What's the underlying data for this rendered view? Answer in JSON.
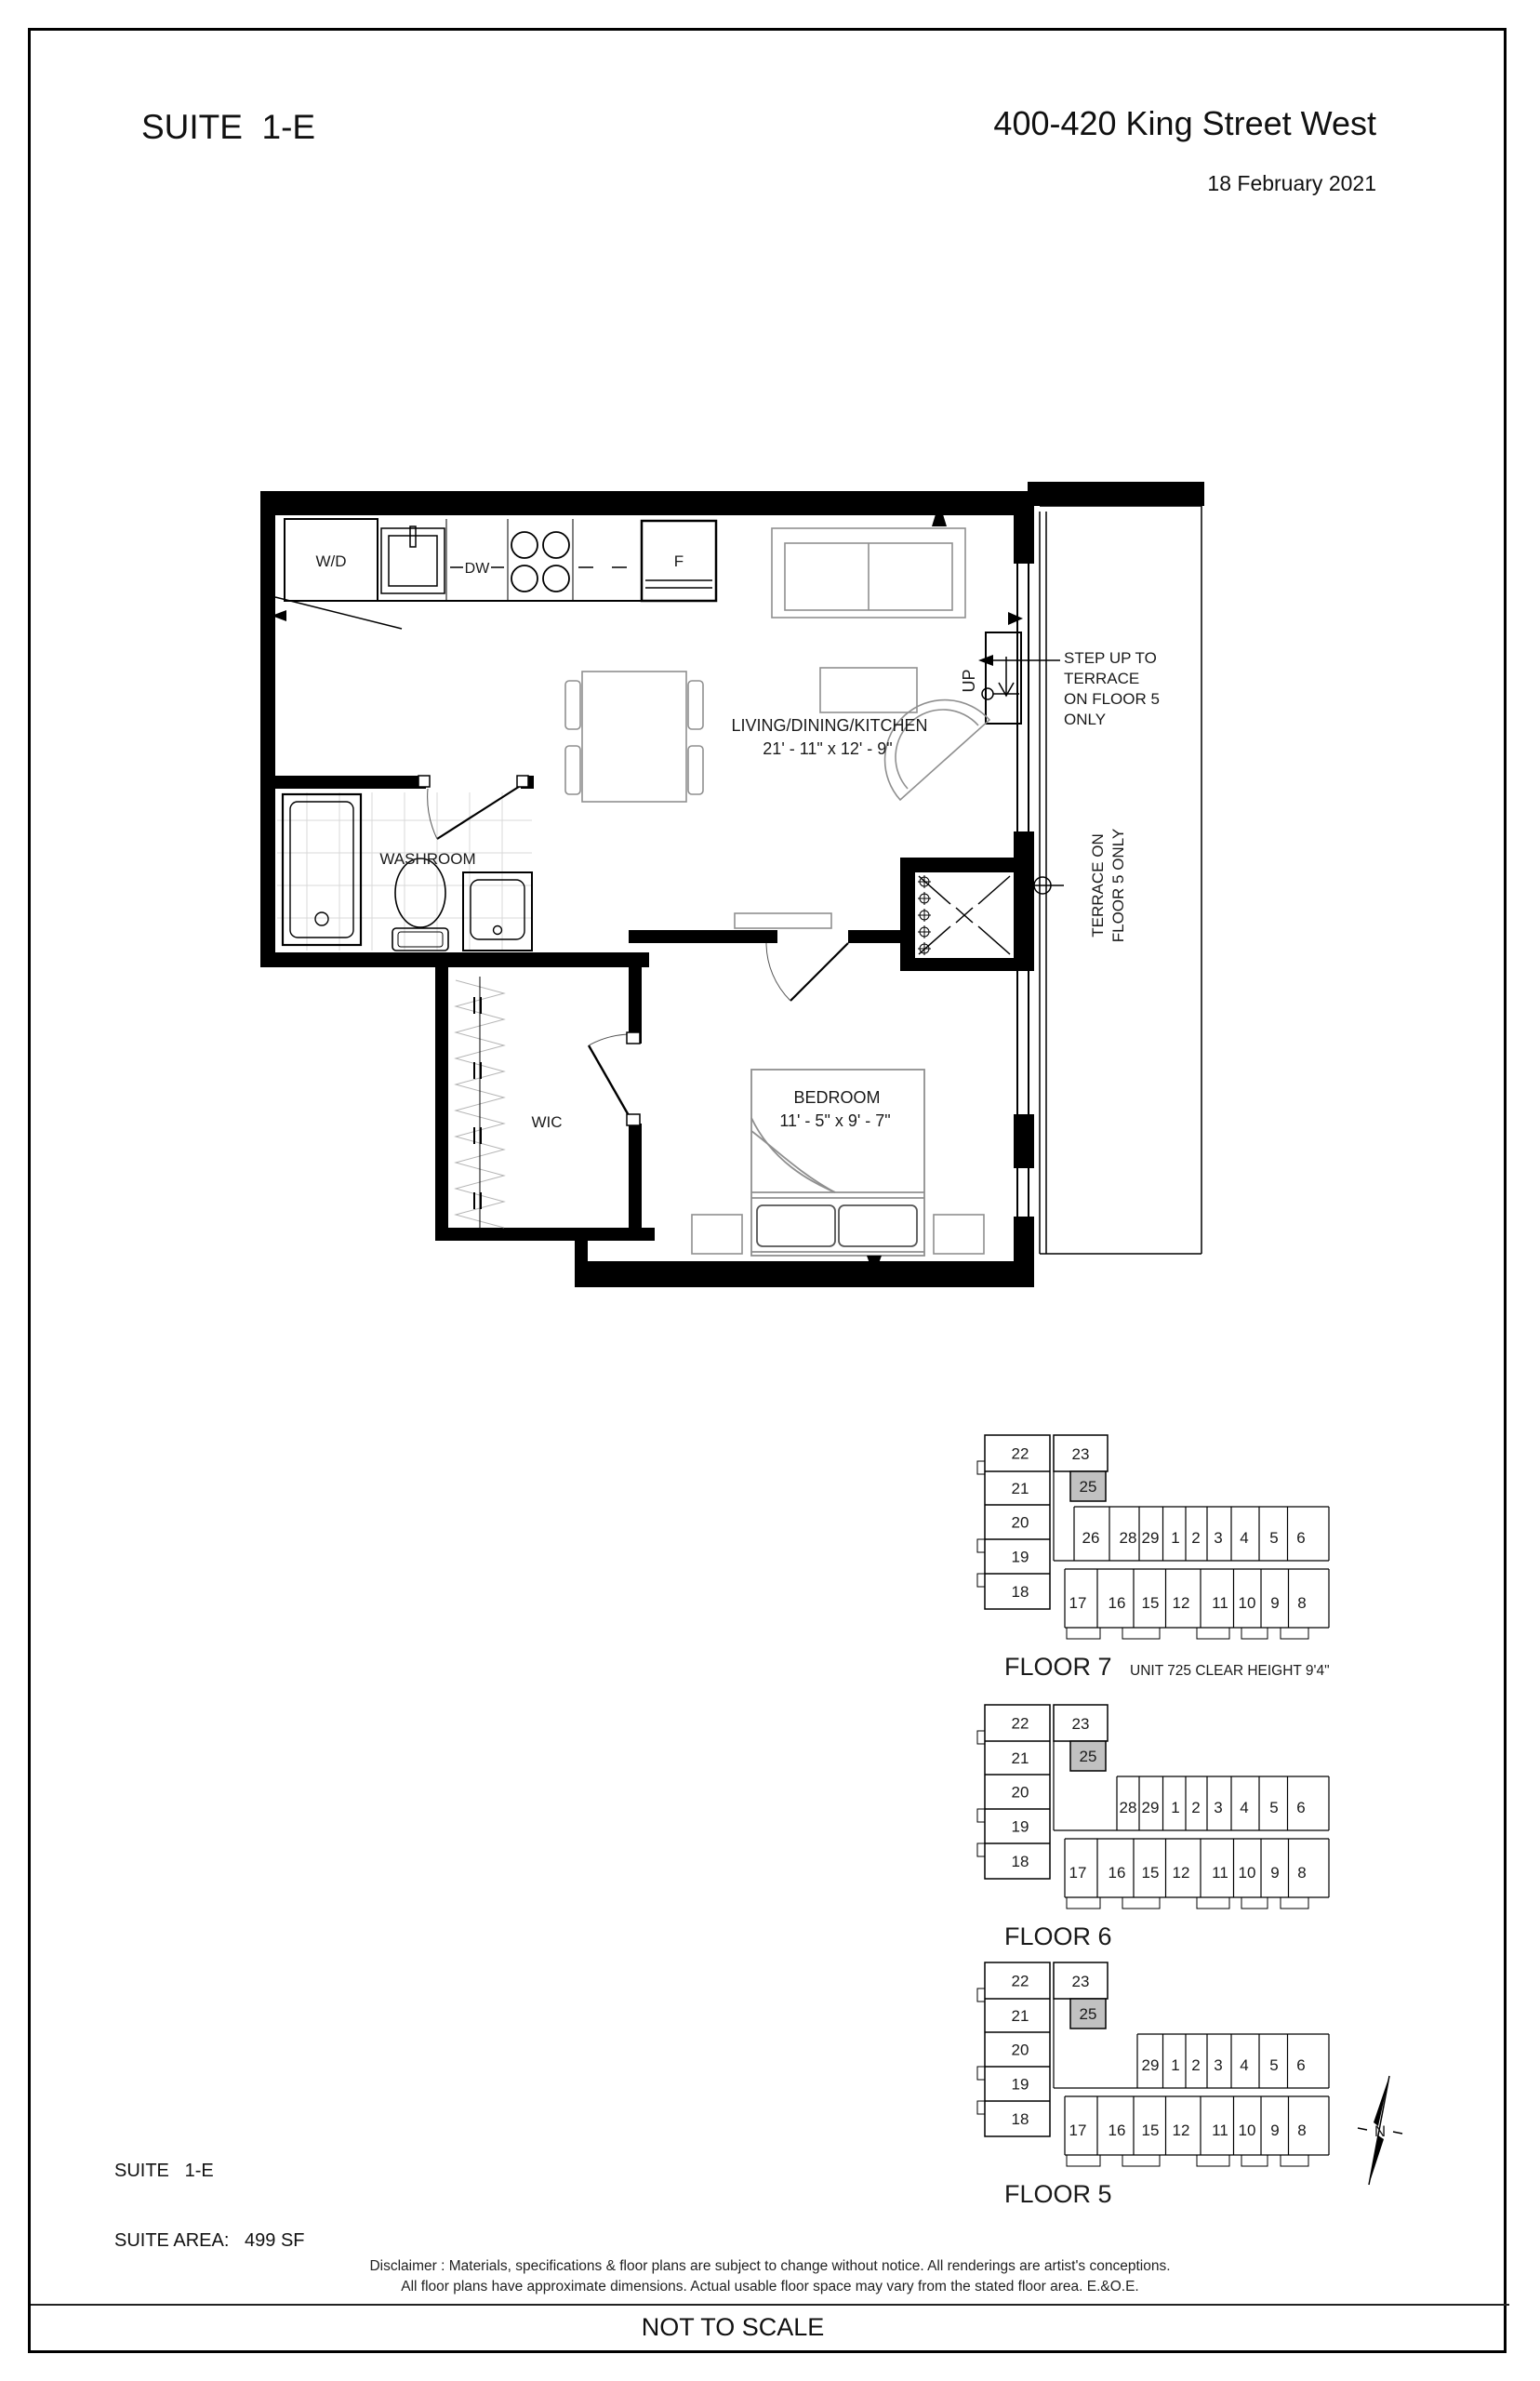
{
  "header": {
    "suite_title": "SUITE  1-E",
    "address": "400-420 King Street West",
    "date": "18 February 2021"
  },
  "floor_plan": {
    "labels": {
      "wd": "W/D",
      "dw": "DW",
      "fridge": "F",
      "living_name": "LIVING/DINING/KITCHEN",
      "living_dims": "21' - 11\" x 12' - 9\"",
      "washroom": "WASHROOM",
      "wic": "WIC",
      "bedroom_name": "BEDROOM",
      "bedroom_dims": "11' - 5\" x 9' - 7\"",
      "up": "UP",
      "step_note": [
        "STEP UP TO",
        "TERRACE",
        "ON FLOOR 5",
        "ONLY"
      ],
      "terrace_note": [
        "TERRACE ON",
        "FLOOR 5 ONLY"
      ]
    }
  },
  "key_plans": [
    {
      "name": "FLOOR 7",
      "annotation": "UNIT 725 CLEAR HEIGHT 9'4\"",
      "left_units": [
        "22",
        "21",
        "20",
        "19",
        "18"
      ],
      "upper_unit": "23",
      "highlight_unit": "25",
      "top_units": [
        "26",
        "28",
        "29",
        "1",
        "2",
        "3",
        "4",
        "5",
        "6"
      ],
      "bottom_units": [
        "17",
        "16",
        "15",
        "12",
        "11",
        "10",
        "9",
        "8"
      ]
    },
    {
      "name": "FLOOR 6",
      "annotation": "",
      "left_units": [
        "22",
        "21",
        "20",
        "19",
        "18"
      ],
      "upper_unit": "23",
      "highlight_unit": "25",
      "top_units": [
        "28",
        "29",
        "1",
        "2",
        "3",
        "4",
        "5",
        "6"
      ],
      "bottom_units": [
        "17",
        "16",
        "15",
        "12",
        "11",
        "10",
        "9",
        "8"
      ]
    },
    {
      "name": "FLOOR 5",
      "annotation": "",
      "left_units": [
        "22",
        "21",
        "20",
        "19",
        "18"
      ],
      "upper_unit": "23",
      "highlight_unit": "25",
      "top_units": [
        "29",
        "1",
        "2",
        "3",
        "4",
        "5",
        "6"
      ],
      "bottom_units": [
        "17",
        "16",
        "15",
        "12",
        "11",
        "10",
        "9",
        "8"
      ]
    }
  ],
  "compass": {
    "label": "N"
  },
  "suite_info": {
    "lines": [
      "SUITE   1-E",
      "SUITE AREA:   499 SF"
    ]
  },
  "disclaimer": [
    "Disclaimer : Materials, specifications & floor plans are subject to change without notice. All renderings are artist's conceptions.",
    "All floor plans have approximate dimensions. Actual usable floor space may vary from the stated floor area. E.&O.E."
  ],
  "footer": {
    "scale_note": "NOT TO SCALE"
  },
  "colors": {
    "highlight": "#c1c1c1",
    "wall": "#000000",
    "furniture": "#8f8f8f"
  }
}
